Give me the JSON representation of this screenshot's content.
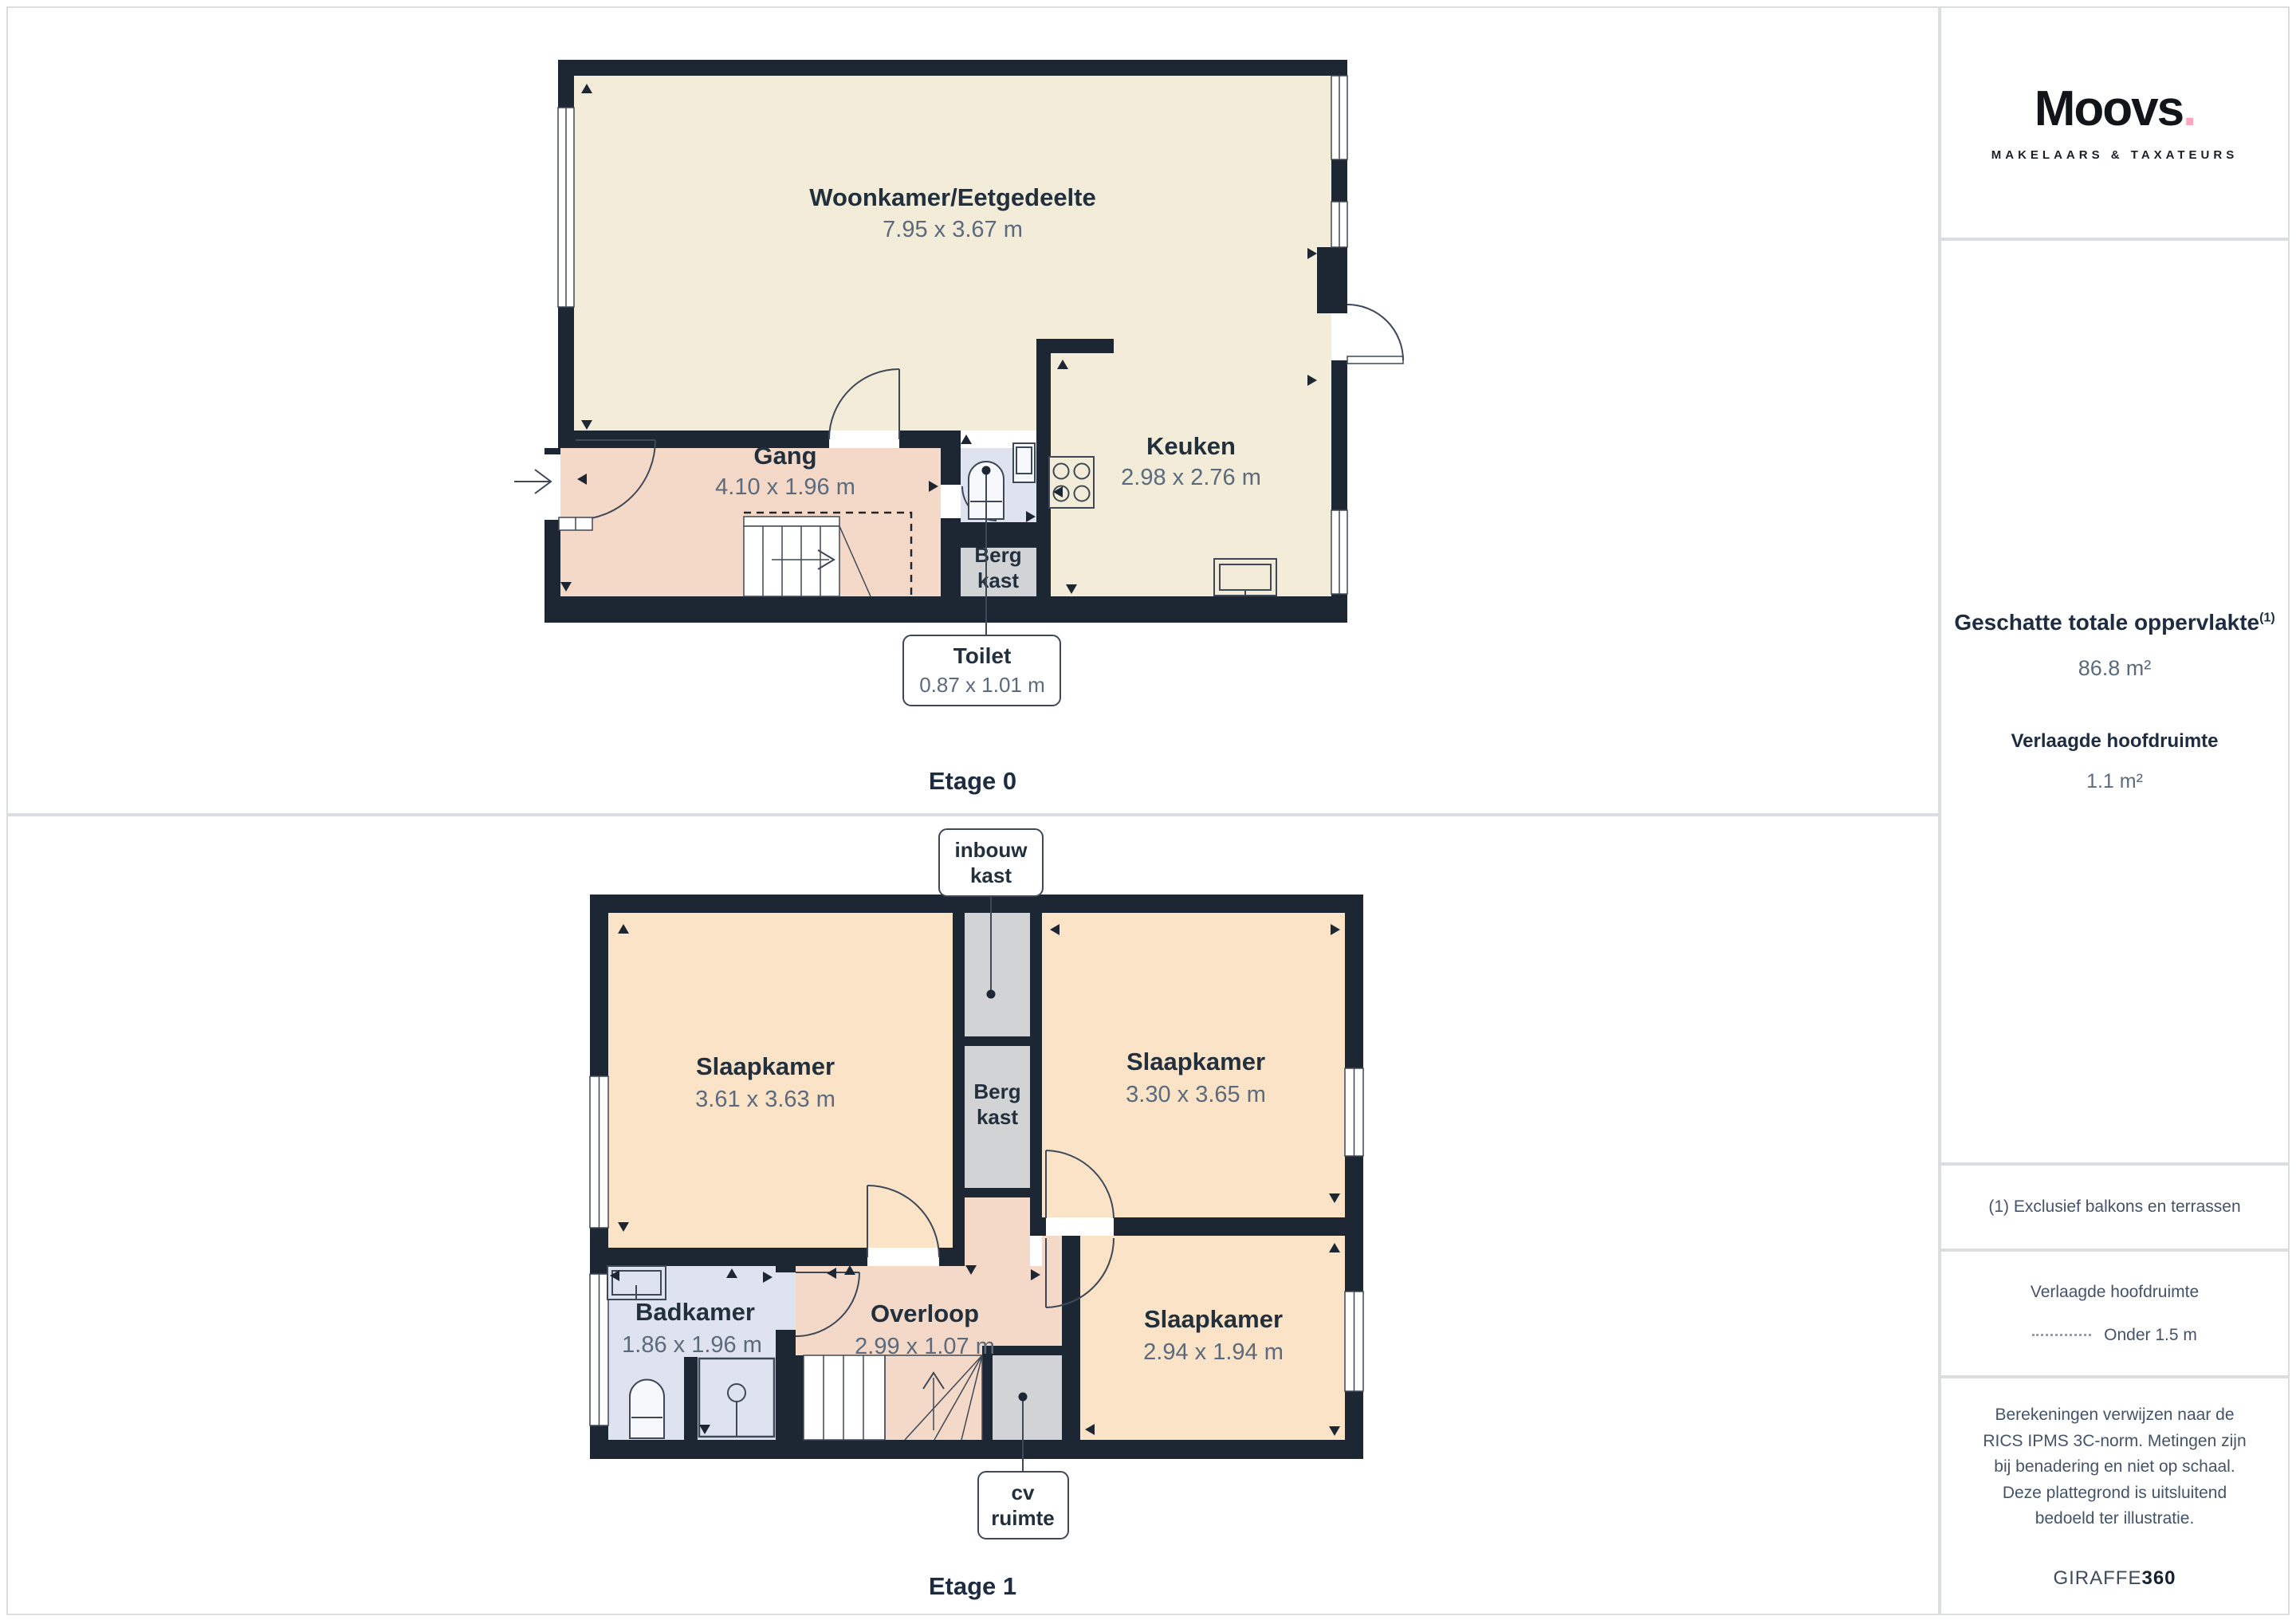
{
  "sidebar": {
    "brand": {
      "logo_text": "Moovs",
      "logo_dot": ".",
      "tagline": "MAKELAARS & TAXATEURS"
    },
    "summary": {
      "total_label": "Geschatte totale oppervlakte",
      "total_sup": "(1)",
      "total_value": "86.8 m²",
      "reduced_label": "Verlaagde hoofdruimte",
      "reduced_value": "1.1 m²"
    },
    "footnote": "(1) Exclusief balkons en terrassen",
    "legend": {
      "title": "Verlaagde hoofdruimte",
      "item": "Onder 1.5 m"
    },
    "disclaimer": "Berekeningen verwijzen naar de RICS IPMS 3C-norm. Metingen zijn bij benadering en niet op schaal. Deze plattegrond is uitsluitend bedoeld ter illustratie.",
    "vendor": {
      "name": "GIRAFFE",
      "suffix": "360"
    }
  },
  "floor0": {
    "label": "Etage 0",
    "rooms": {
      "woonkamer": {
        "name": "Woonkamer/Eetgedeelte",
        "dims": "7.95 x 3.67 m"
      },
      "gang": {
        "name": "Gang",
        "dims": "4.10 x 1.96 m"
      },
      "keuken": {
        "name": "Keuken",
        "dims": "2.98 x 2.76 m"
      },
      "bergkast": {
        "line1": "Berg",
        "line2": "kast"
      },
      "toilet": {
        "name": "Toilet",
        "dims": "0.87 x 1.01 m"
      }
    }
  },
  "floor1": {
    "label": "Etage 1",
    "rooms": {
      "slaapkamer_links": {
        "name": "Slaapkamer",
        "dims": "3.61 x 3.63 m"
      },
      "slaapkamer_rechts": {
        "name": "Slaapkamer",
        "dims": "3.30 x 3.65 m"
      },
      "slaapkamer_onder": {
        "name": "Slaapkamer",
        "dims": "2.94 x 1.94 m"
      },
      "badkamer": {
        "name": "Badkamer",
        "dims": "1.86 x 1.96 m"
      },
      "overloop": {
        "name": "Overloop",
        "dims": "2.99 x 1.07 m"
      },
      "bergkast": {
        "line1": "Berg",
        "line2": "kast"
      },
      "inbouwkast": {
        "line1": "inbouw",
        "line2": "kast"
      },
      "cv": {
        "line1": "cv",
        "line2": "ruimte"
      }
    }
  },
  "colors": {
    "wall": "#1d2734",
    "living_cream": "#f2ecd8",
    "hall_pink": "#f4d9c9",
    "bedroom_peach": "#fbe3c8",
    "bath_blue": "#dfe3f0",
    "closet_gray": "#d2d3d4",
    "accent_dot": "#f8a7bd",
    "text_dark": "#1d2c40",
    "text_dim": "#5b6b7d"
  }
}
